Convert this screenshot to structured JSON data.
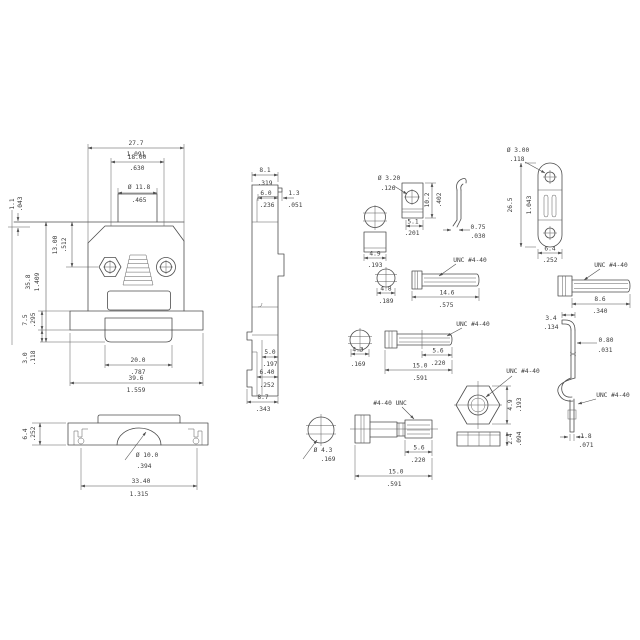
{
  "drawing_title": "D-sub connector hood kit technical drawing",
  "labels": {
    "unc": "UNC  #4-40",
    "unc_rev": "#4-40  UNC"
  },
  "dims": {
    "fv_top_w": [
      "27.7",
      "1.091"
    ],
    "fv_inner_w": [
      "18.00",
      ".630"
    ],
    "fv_dia": [
      "Ø 11.8",
      ".465"
    ],
    "fv_lip": [
      "1.1",
      ".043"
    ],
    "fv_screw_y": [
      "13.00",
      ".512"
    ],
    "fv_h": [
      "35.8",
      "1.409"
    ],
    "fv_flange_h": [
      "7.5",
      ".295"
    ],
    "fv_step": [
      "3.0",
      ".118"
    ],
    "fv_conn_w": [
      "20.0",
      ".787"
    ],
    "fv_total_w": [
      "39.6",
      "1.559"
    ],
    "sv_top_w": [
      "8.1",
      ".319"
    ],
    "sv_mid_w": [
      "6.0",
      ".236"
    ],
    "sv_lip": [
      "1.3",
      ".051"
    ],
    "sv_b1": [
      "5.0",
      ".197"
    ],
    "sv_b2": [
      "6.40",
      ".252"
    ],
    "sv_b3": [
      "8.7",
      ".343"
    ],
    "bv_h": [
      "6.4",
      ".252"
    ],
    "bv_dia": [
      "Ø 10.0",
      ".394"
    ],
    "bv_w": [
      "33.40",
      "1.315"
    ],
    "sp_hole": [
      "Ø 3.00",
      ".118"
    ],
    "sp_h": [
      "26.5",
      "1.043"
    ],
    "sp_w": [
      "6.4",
      ".252"
    ],
    "rs_len": [
      "8.6",
      ".340"
    ],
    "lp_hole": [
      "Ø 3.20",
      ".126"
    ],
    "lp_h": [
      "10.2",
      ".402"
    ],
    "lp_w": [
      "5.1",
      ".201"
    ],
    "cl_t": [
      "0.75",
      ".030"
    ],
    "so_d": [
      "4.9",
      ".193"
    ],
    "s2_head": [
      "4.8",
      ".189"
    ],
    "s2_len": [
      "14.6",
      ".575"
    ],
    "s3_head": [
      "4.3",
      ".169"
    ],
    "s3_thread": [
      "5.6",
      ".220"
    ],
    "s3_len": [
      "15.0",
      ".591"
    ],
    "js_head": [
      "Ø 4.3",
      ".169"
    ],
    "js_thread": [
      "5.6",
      ".220"
    ],
    "js_len": [
      "15.0",
      ".591"
    ],
    "hn_w": [
      "4.9",
      ".193"
    ],
    "hn_t": [
      "2.4",
      ".094"
    ],
    "zc_top": [
      "3.4",
      ".134"
    ],
    "zc_t": [
      "0.80",
      ".031"
    ],
    "zc_bot": [
      "1.8",
      ".071"
    ]
  }
}
